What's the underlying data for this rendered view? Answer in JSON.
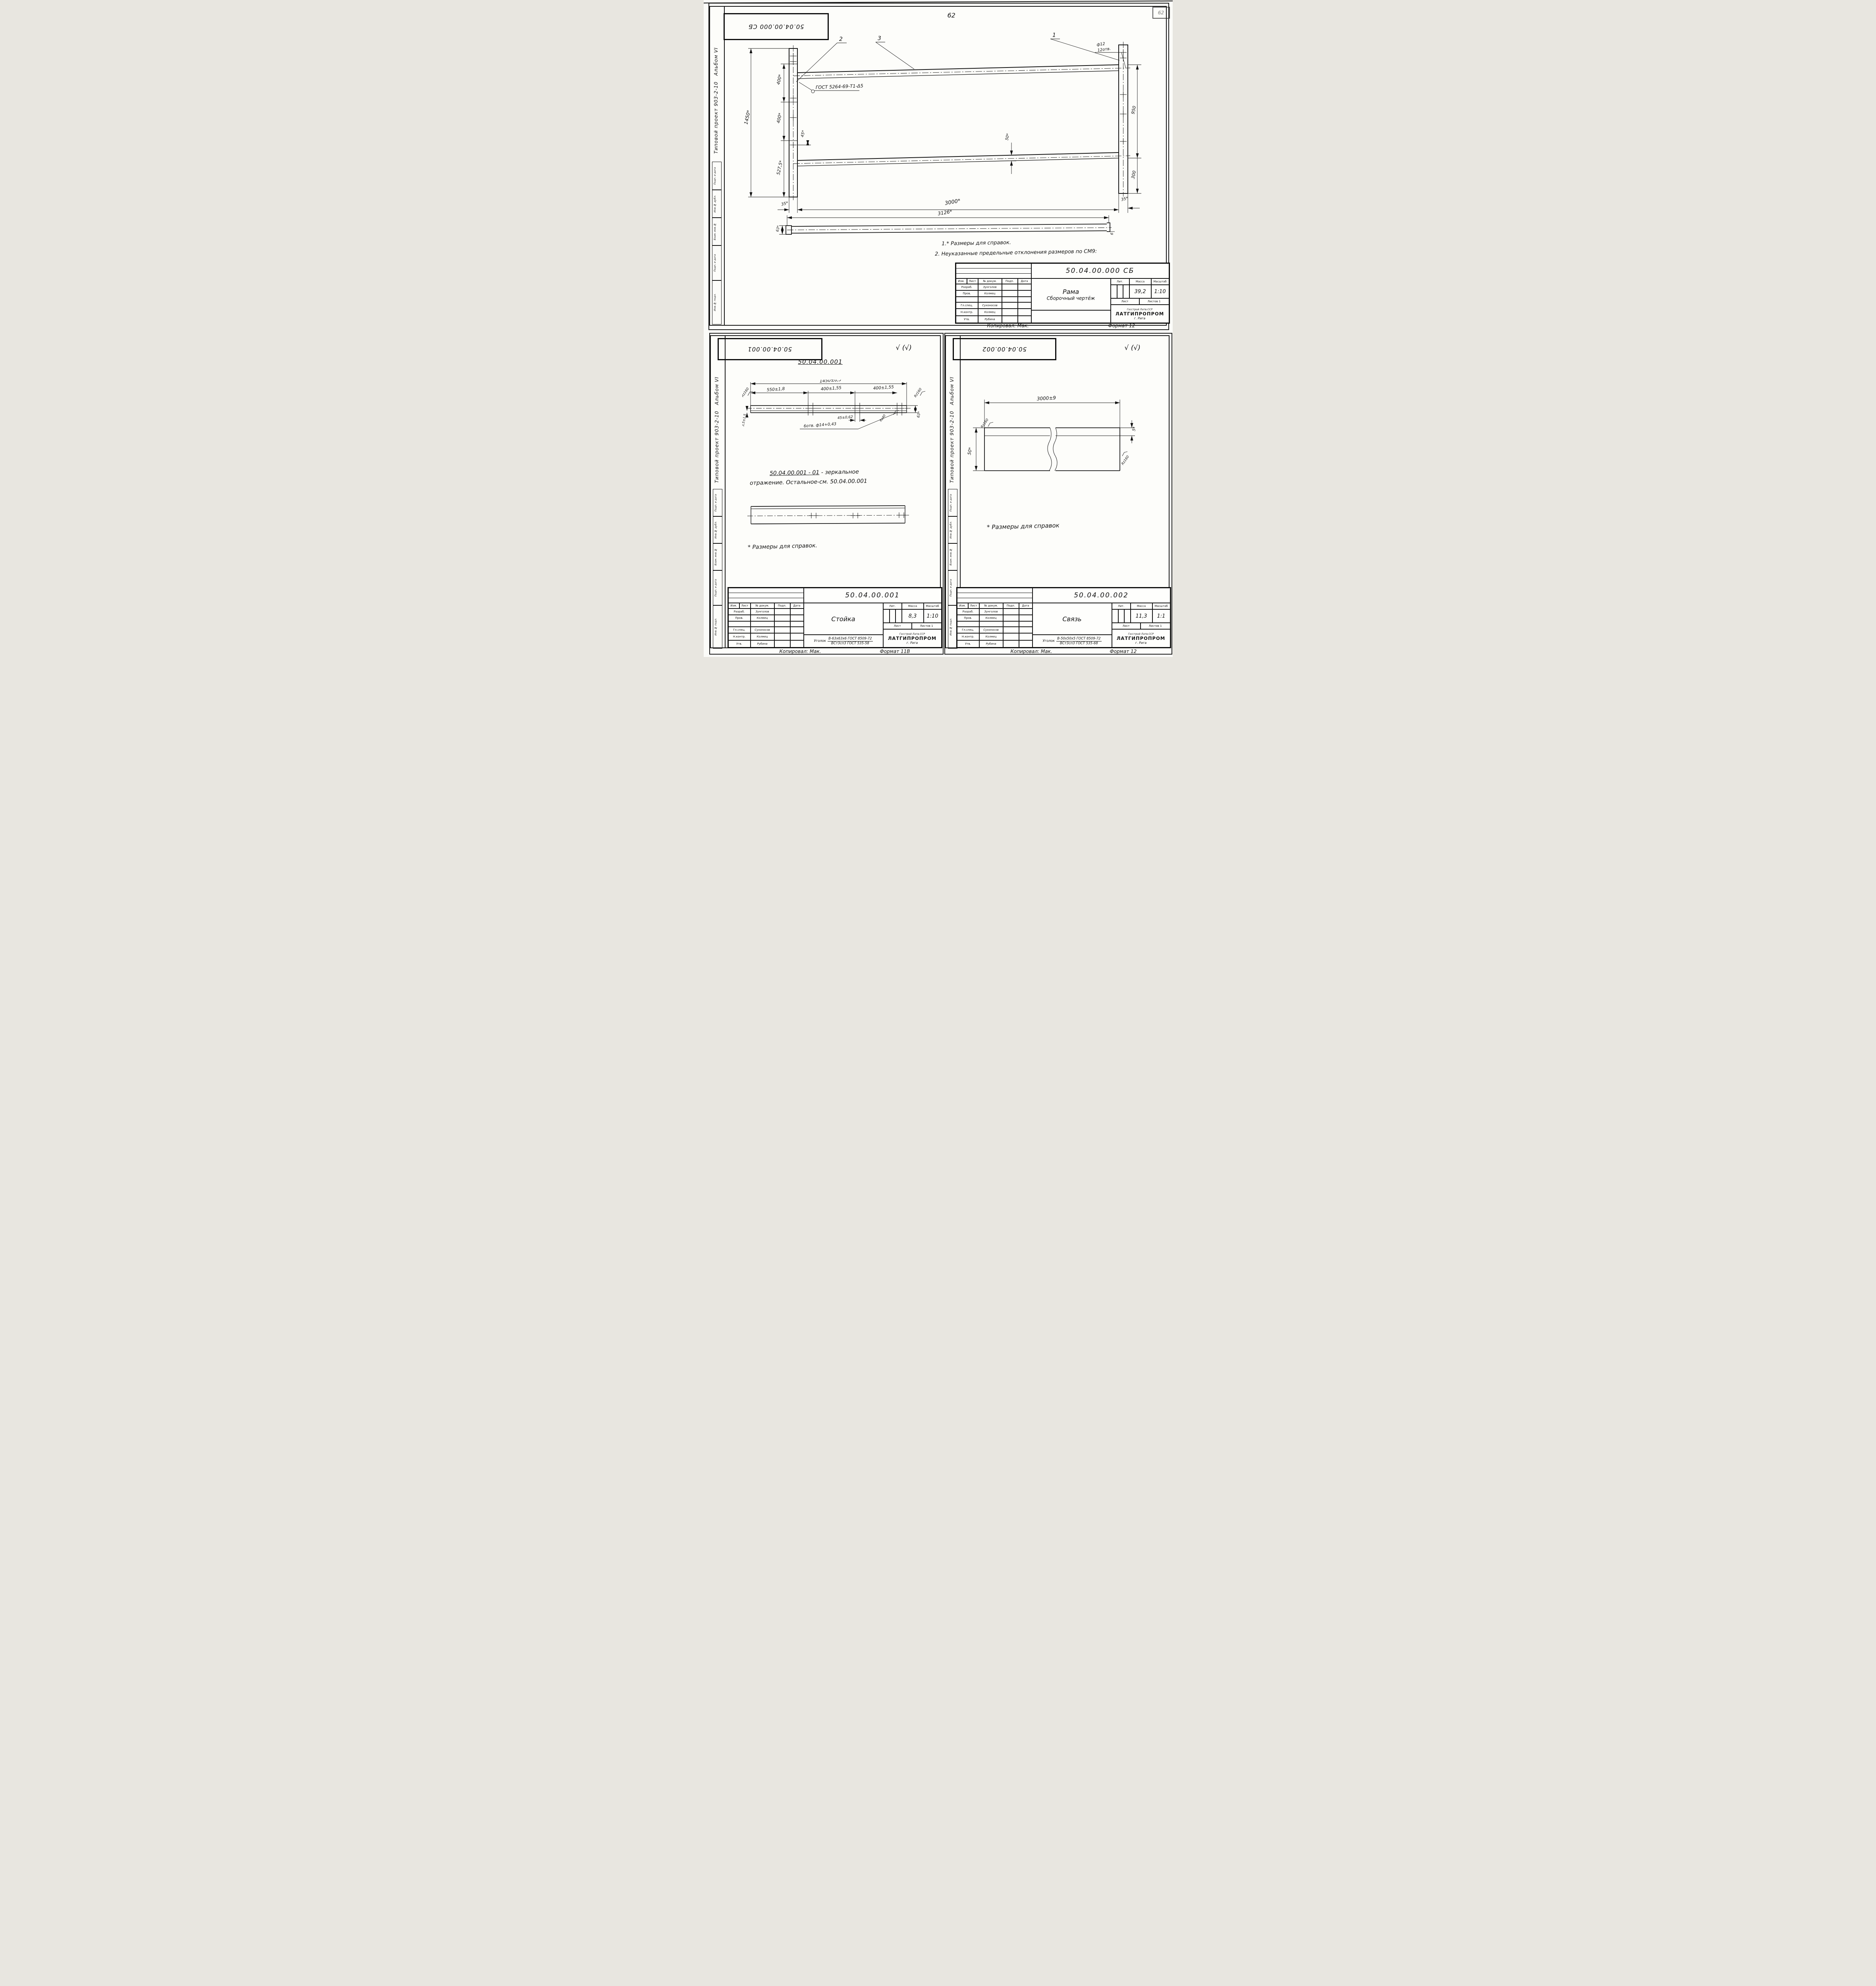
{
  "page": {
    "number": "62",
    "corner_mark": "62",
    "check": "√ (√)"
  },
  "sidebar": {
    "project": "Типовой проект 903-2-10",
    "album": "Альбом VI",
    "box1": "Подп. и дата",
    "box2": "Инв.№ дубл.",
    "box3": "Взам. инв.№",
    "box4": "Подп. и дата",
    "box5": "Инв.№ подл."
  },
  "tb": {
    "izm": "Изм.",
    "list": "Лист",
    "doc": "№ докум.",
    "podp": "Подп.",
    "date": "Дата",
    "lit": "Лит.",
    "mass": "Масса",
    "scale": "Масштаб",
    "sheet": "Лист",
    "sheets": "Листов 1",
    "org1": "Госстрой Латв.ССР",
    "org2": "ЛАТГИПРОПРОМ",
    "org3": "г. Рига",
    "ugolok": "Уголок",
    "copied": "Копировал: Мак.",
    "r1": "Разраб.",
    "n1": "Зунголов",
    "r2": "Пров.",
    "n2": "Колмец",
    "r3": "Гл.спец.",
    "n3": "Сухоносов",
    "r4": "Н.контр.",
    "n4": "Колмец",
    "r5": "Утв.",
    "n5": "Рубина"
  },
  "assembly": {
    "stamp": "50.04.00.000 СБ",
    "doc_number": "50.04.00.000 СБ",
    "name": "Рама",
    "type": "Сборочный чертёж",
    "mass": "39,2",
    "scale": "1:10",
    "format": "Формат 12",
    "note1": "1.* Размеры для справок.",
    "note2": "2. Неуказанные предельные отклонения размеров по СМ9:",
    "weld": "ГОСТ 5264-69-Т1-Δ5",
    "c1": "1",
    "c2": "2",
    "c3": "3",
    "dia": "ф12",
    "dia_count": "12отв.",
    "d_total": "1450*",
    "d_a": "400*",
    "d_b": "400*",
    "d_c": "45*",
    "d_d": "527,5*",
    "d_off_l": "35*",
    "d_span": "3000*",
    "d_off_r": "35*",
    "d_side": "3126*",
    "d_side_h": "63*",
    "d_side_t": "6",
    "d_right_a": "950",
    "d_right_b": "300",
    "d_rail": "50*"
  },
  "post": {
    "stamp": "50.04.00.001",
    "heading": "50.04.00.001",
    "doc_number": "50.04.00.001",
    "name": "Стойка",
    "mass": "8,3",
    "scale": "1:10",
    "format": "Формат 11В",
    "mirror_num": "50.04.00.001 - 01",
    "mirror_rest": "- зеркальное",
    "mirror_line2": "отражение. Остальное-см. 50.04.00.001",
    "footnote": "* Размеры для справок.",
    "mat1": "В-63х63х6 ГОСТ 8509-72",
    "mat2": "ВСт3сп3 ГОСТ 535-58",
    "d_total": "1450±6,5",
    "d_s1": "550±1,8",
    "d_s2": "400±1,55",
    "d_s3": "400±1,55",
    "d_hole": "45±0,62",
    "d_holes": "6отв. ф14+0,43",
    "rz40": "Rz40",
    "rz160": "Rz160",
    "d_h": "63*",
    "d_t": "3,5±1,5"
  },
  "tie": {
    "stamp": "50.04.00.002",
    "doc_number": "50.04.00.002",
    "name": "Связь",
    "mass": "11,3",
    "scale": "1:1",
    "format": "Формат 12",
    "footnote": "* Размеры для справок",
    "mat1": "В-50х50х5 ГОСТ 8509-72",
    "mat2": "ВСт3сп3 ГОСТ 535-68",
    "d_len": "3000±9",
    "d_t": "5*",
    "d_h": "50*",
    "rz1": "Rz160",
    "rz2": "Rz160"
  }
}
